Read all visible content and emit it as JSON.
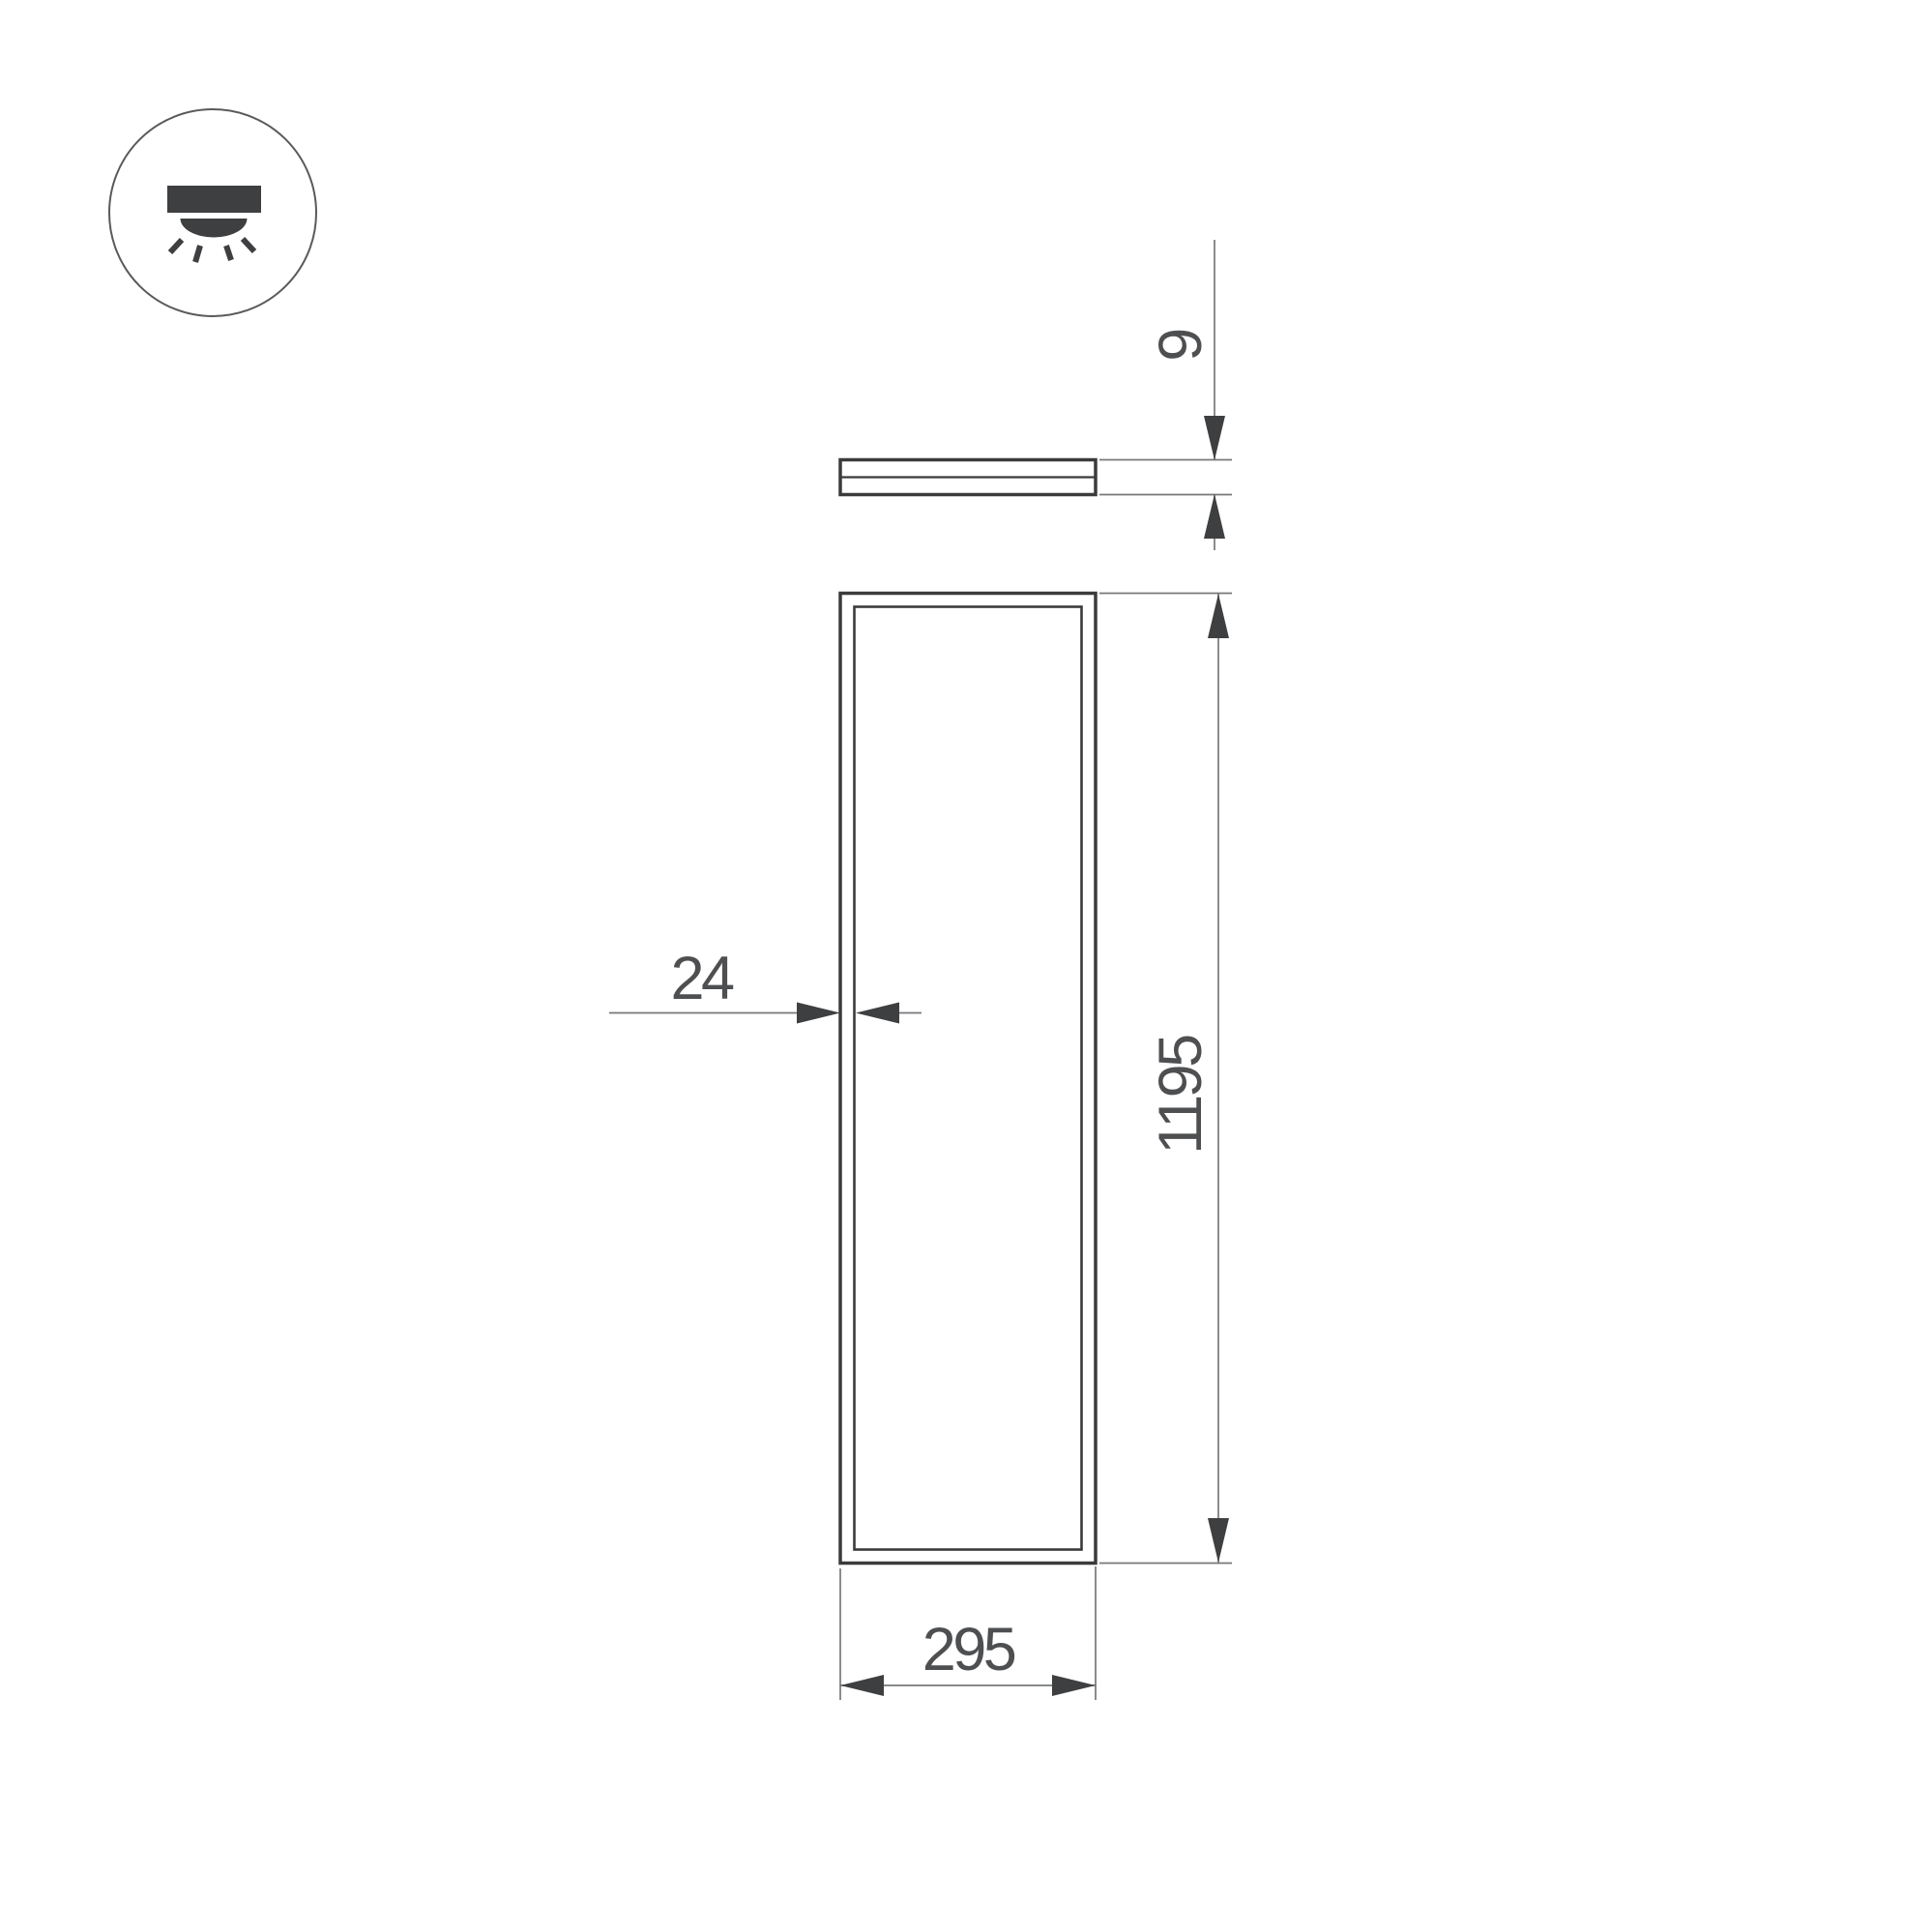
{
  "icon": {
    "name": "recessed-downlight-icon"
  },
  "dimensions": {
    "thickness": "9",
    "frame": "24",
    "length": "1195",
    "width": "295"
  },
  "colors": {
    "outline": "#3a3b3d",
    "dim-line": "#77787a",
    "arrow": "#3e3f41",
    "text": "#4e4f51",
    "background": "#ffffff"
  }
}
